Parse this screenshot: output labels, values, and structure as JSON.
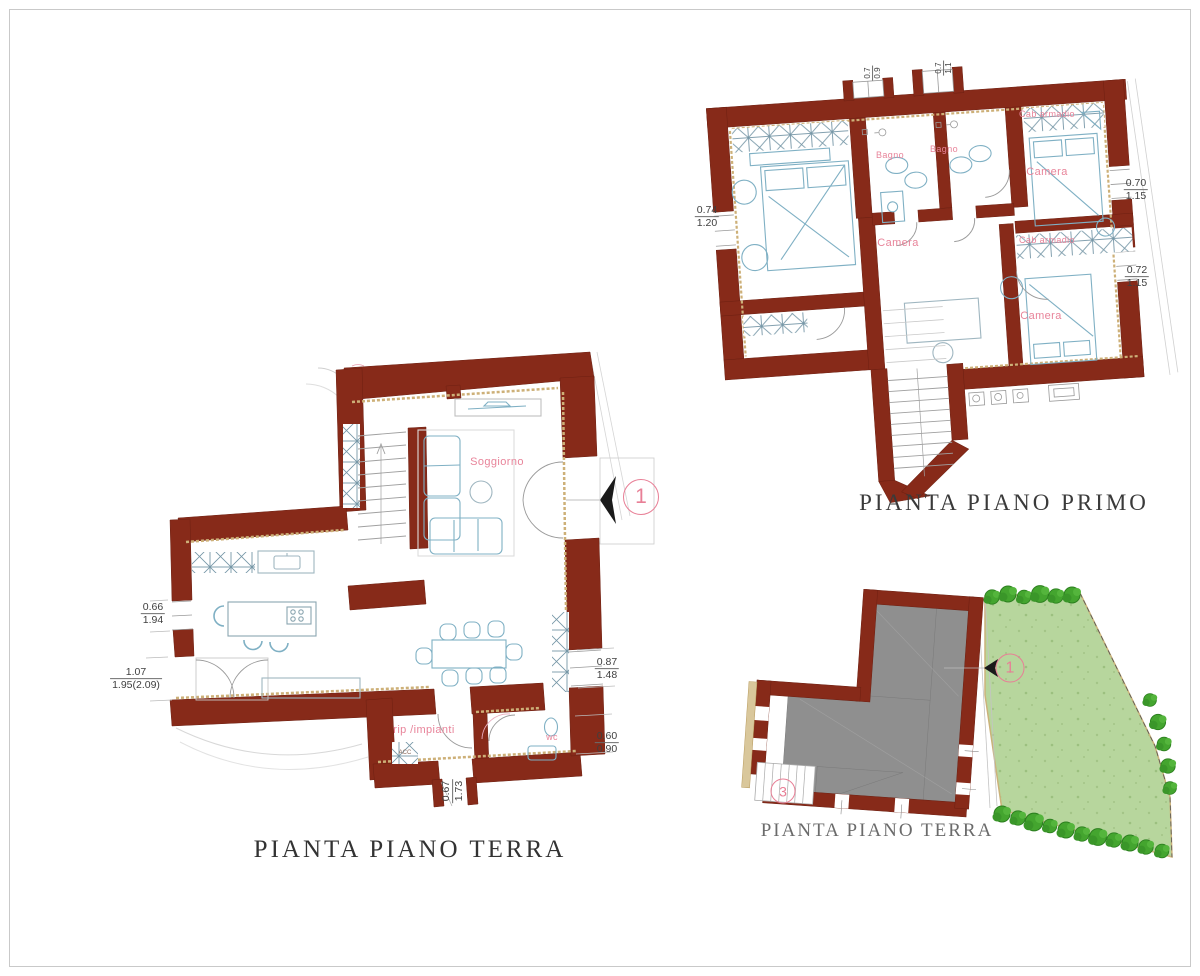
{
  "drawing": {
    "background": "#ffffff",
    "frame_color": "#c9c9c9"
  },
  "palette": {
    "wall": "#872a19",
    "wall_finish": "#cdb078",
    "furniture_line": "#7fb0c4",
    "detail_line": "#999999",
    "room_label": "#e8849a",
    "dimension_text": "#3f3f3f",
    "marker": "#e87f96",
    "title_dark": "#333333",
    "title_gray": "#6b6b6b",
    "building_fill": "#8f8f8f",
    "garden_fill": "#b7d69d",
    "tree_fill": "#44a52f"
  },
  "ground_floor": {
    "title": "PIANTA PIANO TERRA",
    "marker": "1",
    "rooms": {
      "soggiorno": "Soggiorno",
      "rip_impianti": "rip /impianti",
      "wc": "wc",
      "acc": "ACC"
    },
    "dims": {
      "left_upper": {
        "top": "0.66",
        "bottom": "1.94"
      },
      "left_lower": {
        "top": "1.07",
        "bottom": "1.95(2.09)"
      },
      "right_upper": {
        "top": "0.87",
        "bottom": "1.48"
      },
      "right_lower": {
        "top": "0.60",
        "bottom": "0.90"
      },
      "bottom": {
        "top": "0.67",
        "bottom": "1.73"
      }
    }
  },
  "first_floor": {
    "title": "PIANTA PIANO PRIMO",
    "rooms": {
      "bagno_left": "Bagno",
      "bagno_right": "Bagno",
      "camera_center": "Camera",
      "camera_right_top": "Camera",
      "camera_right_bottom": "Camera",
      "cab_armadio_top": "Cab armadio",
      "cab_armadio_mid": "Cab armadio"
    },
    "dims": {
      "left": {
        "top": "0.74",
        "bottom": "1.20"
      },
      "right_upper": {
        "top": "0.70",
        "bottom": "1.15"
      },
      "right_lower": {
        "top": "0.72",
        "bottom": "1.15"
      },
      "top_left": {
        "top": "0.7",
        "bottom": "0.9"
      },
      "top_right": {
        "top": "0.7",
        "bottom": "1.1"
      }
    }
  },
  "site_plan": {
    "title": "PIANTA PIANO TERRA",
    "marker_entrance": "1",
    "marker_stairs": "3"
  }
}
